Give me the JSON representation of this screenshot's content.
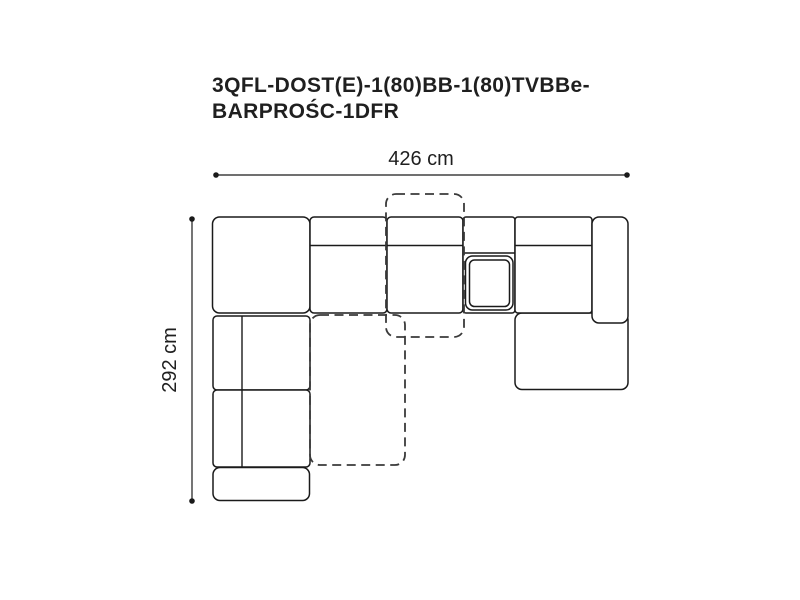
{
  "title": {
    "line1": "3QFL-DOST(E)-1(80)BB-1(80)TVBBe-",
    "line2": "BARPROŚC-1DFR"
  },
  "dimensions": {
    "width_label": "426 cm",
    "height_label": "292 cm"
  },
  "colors": {
    "background": "#ffffff",
    "line": "#1a1a1a",
    "dashed_line": "#3a3a3a",
    "text": "#1f1f1f"
  }
}
